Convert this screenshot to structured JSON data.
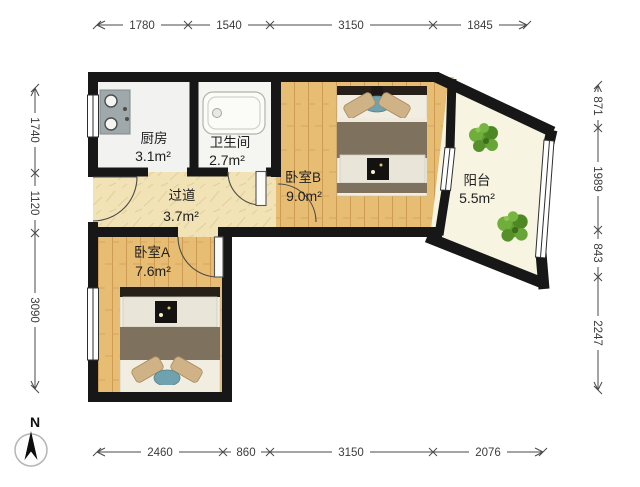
{
  "title": "apartment-floor-plan",
  "rooms": {
    "kitchen": {
      "name": "厨房",
      "area": "3.1m²"
    },
    "bathroom": {
      "name": "卫生间",
      "area": "2.7m²"
    },
    "hallway": {
      "name": "过道",
      "area": "3.7m²"
    },
    "bedroomA": {
      "name": "卧室A",
      "area": "7.6m²"
    },
    "bedroomB": {
      "name": "卧室B",
      "area": "9.0m²"
    },
    "balcony": {
      "name": "阳台",
      "area": "5.5m²"
    }
  },
  "dimensions": {
    "top": [
      "1780",
      "1540",
      "3150",
      "1845"
    ],
    "bottom": [
      "2460",
      "860",
      "3150",
      "2076"
    ],
    "left": [
      "1740",
      "1120",
      "3090"
    ],
    "right": [
      "871",
      "1989",
      "843",
      "2247"
    ]
  },
  "compass": {
    "label": "N"
  },
  "colors": {
    "wall": "#171717",
    "wood_floor": "#e7bd74",
    "wood_line": "#cd9c52",
    "hall_floor": "#f1e3b5",
    "balcony_floor": "#f7f4e1",
    "kitchen_floor": "#f2f3f0",
    "bathroom_floor": "#f5f5f2",
    "blanket": "#7e715d",
    "sheet": "#f1ede1",
    "pillow": "#cfb387",
    "teal_pillow": "#6fa2ae",
    "plant_green": "#5f9c31",
    "stove_gray": "#9fa9ab",
    "dim_line": "#4a4a4a"
  }
}
